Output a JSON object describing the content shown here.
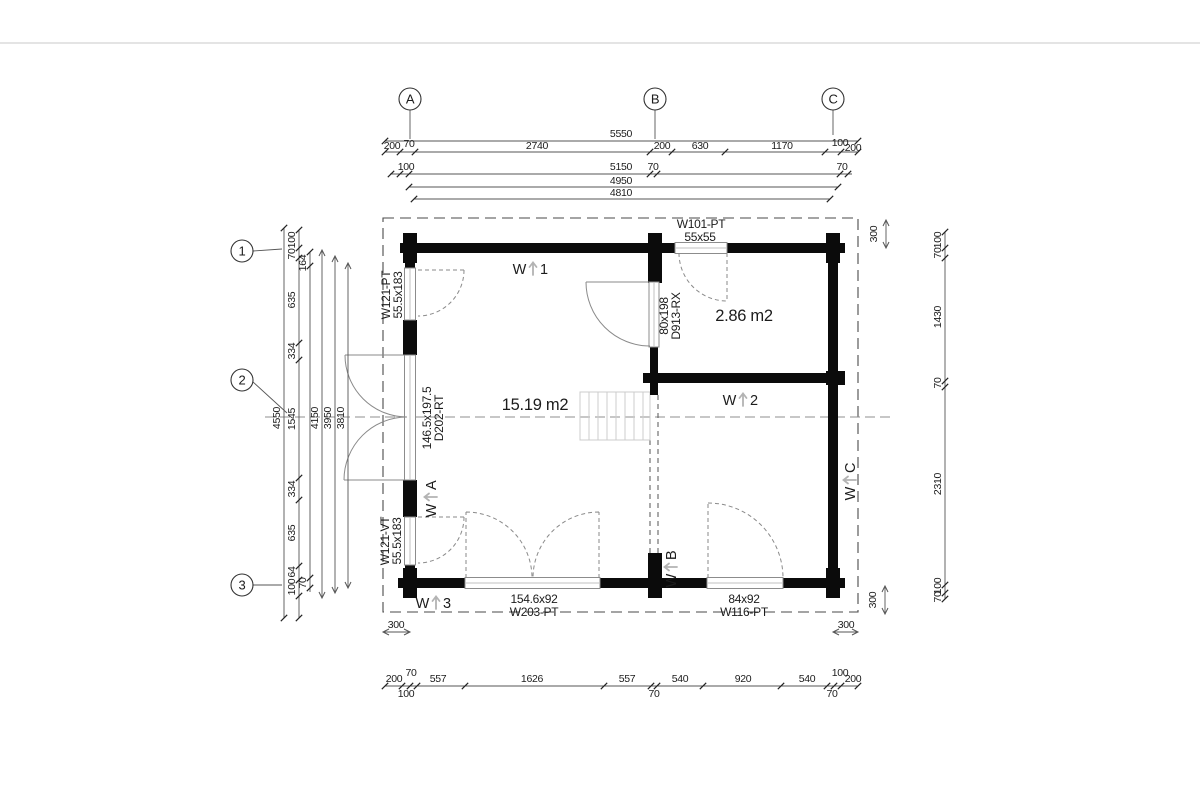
{
  "drawing_type": "floor-plan",
  "grid": {
    "cols": [
      {
        "label": "A",
        "cx": 410,
        "cy": 99,
        "lx1": 410,
        "ly1": 110,
        "lx2": 410,
        "ly2": 139
      },
      {
        "label": "B",
        "cx": 655,
        "cy": 99,
        "lx1": 655,
        "ly1": 110,
        "lx2": 655,
        "ly2": 139
      },
      {
        "label": "C",
        "cx": 833,
        "cy": 99,
        "lx1": 833,
        "ly1": 110,
        "lx2": 833,
        "ly2": 135
      }
    ],
    "rows": [
      {
        "label": "1",
        "cx": 242,
        "cy": 251,
        "lx1": 253,
        "ly1": 251,
        "lx2": 282,
        "ly2": 249
      },
      {
        "label": "2",
        "cx": 242,
        "cy": 380,
        "lx1": 253,
        "ly1": 382,
        "lx2": 287,
        "ly2": 413
      },
      {
        "label": "3",
        "cx": 242,
        "cy": 585,
        "lx1": 253,
        "ly1": 585,
        "lx2": 282,
        "ly2": 585
      }
    ]
  },
  "rooms": [
    {
      "name": "room-area-main",
      "text": "15.19 m2",
      "x": 535,
      "y": 410
    },
    {
      "name": "room-area-small",
      "text": "2.86 m2",
      "x": 744,
      "y": 321
    }
  ],
  "opening_labels": [
    {
      "name": "window-w101-label",
      "text": "W101-PT",
      "x": 701,
      "y": 228,
      "rot": 0
    },
    {
      "name": "window-w101-size",
      "text": "55x55",
      "x": 700,
      "y": 241,
      "rot": 0
    },
    {
      "name": "window-w121pt-label",
      "text": "W121-PT",
      "x": 390,
      "y": 295,
      "rot": -90
    },
    {
      "name": "window-w121pt-size",
      "text": "55.5x183",
      "x": 402,
      "y": 295,
      "rot": -90
    },
    {
      "name": "door-d202-size",
      "text": "146.5x197.5",
      "x": 431,
      "y": 418,
      "rot": -90
    },
    {
      "name": "door-d202-label",
      "text": "D202-RT",
      "x": 443,
      "y": 418,
      "rot": -90
    },
    {
      "name": "window-w121vt-label",
      "text": "W121-VT",
      "x": 389,
      "y": 541,
      "rot": -90
    },
    {
      "name": "window-w121vt-size",
      "text": "55.5x183",
      "x": 401,
      "y": 541,
      "rot": -90
    },
    {
      "name": "door-d913-size",
      "text": "80x198",
      "x": 668,
      "y": 316,
      "rot": -90
    },
    {
      "name": "door-d913-label",
      "text": "D913-RX",
      "x": 680,
      "y": 316,
      "rot": -90
    },
    {
      "name": "window-w203-size",
      "text": "154.6x92",
      "x": 534,
      "y": 603,
      "rot": 0
    },
    {
      "name": "window-w203-label",
      "text": "W203-PT",
      "x": 534,
      "y": 616,
      "rot": 0
    },
    {
      "name": "window-w116-size",
      "text": "84x92",
      "x": 744,
      "y": 603,
      "rot": 0
    },
    {
      "name": "window-w116-label",
      "text": "W116-PT",
      "x": 744,
      "y": 616,
      "rot": 0
    }
  ],
  "wall_marks": [
    {
      "name": "wall-mark-w1",
      "left": "W",
      "right": "1",
      "x": 531,
      "y": 269,
      "rot": 0
    },
    {
      "name": "wall-mark-w2",
      "left": "W",
      "right": "2",
      "x": 741,
      "y": 400,
      "rot": 0
    },
    {
      "name": "wall-mark-w3",
      "left": "W",
      "right": "3",
      "x": 434,
      "y": 603,
      "rot": 0
    },
    {
      "name": "wall-mark-wa",
      "left": "W",
      "right": "A",
      "x": 431,
      "y": 499,
      "rot": -90
    },
    {
      "name": "wall-mark-wb",
      "left": "W",
      "right": "B",
      "x": 671,
      "y": 569,
      "rot": -90
    },
    {
      "name": "wall-mark-wc",
      "left": "W",
      "right": "C",
      "x": 850,
      "y": 482,
      "rot": -90
    }
  ],
  "dims": {
    "h": [
      {
        "y": 141,
        "x1": 385,
        "x2": 858,
        "ticks": [
          385,
          858
        ],
        "arrows": false,
        "labels": [
          {
            "t": "5550",
            "x": 621,
            "y": 137
          }
        ]
      },
      {
        "y": 152,
        "x1": 385,
        "x2": 858,
        "ticks": [
          385,
          400,
          415,
          650,
          672,
          725,
          825,
          841,
          858
        ],
        "arrows": false,
        "labels": [
          {
            "t": "200",
            "x": 392,
            "y": 149
          },
          {
            "t": "70",
            "x": 409,
            "y": 147
          },
          {
            "t": "2740",
            "x": 537,
            "y": 149
          },
          {
            "t": "200",
            "x": 662,
            "y": 149
          },
          {
            "t": "630",
            "x": 700,
            "y": 149
          },
          {
            "t": "1170",
            "x": 782,
            "y": 149
          },
          {
            "t": "100",
            "x": 840,
            "y": 146
          },
          {
            "t": "200",
            "x": 853,
            "y": 151
          }
        ]
      },
      {
        "y": 174,
        "x1": 390,
        "x2": 852,
        "ticks": [
          391,
          400,
          409,
          650,
          657,
          840,
          848
        ],
        "arrows": false,
        "labels": [
          {
            "t": "100",
            "x": 406,
            "y": 170
          },
          {
            "t": "5150",
            "x": 621,
            "y": 170
          },
          {
            "t": "70",
            "x": 653,
            "y": 170
          },
          {
            "t": "70",
            "x": 842,
            "y": 170
          }
        ]
      },
      {
        "y": 187,
        "x1": 409,
        "x2": 838,
        "ticks": [
          409,
          838
        ],
        "arrows": false,
        "labels": [
          {
            "t": "4950",
            "x": 621,
            "y": 184
          }
        ]
      },
      {
        "y": 199,
        "x1": 414,
        "x2": 830,
        "ticks": [
          414,
          830
        ],
        "arrows": false,
        "labels": [
          {
            "t": "4810",
            "x": 621,
            "y": 196
          }
        ]
      },
      {
        "y": 686,
        "x1": 385,
        "x2": 858,
        "ticks": [
          385,
          402,
          410,
          417,
          465,
          604,
          651,
          657,
          703,
          781,
          827,
          834,
          841,
          858
        ],
        "arrows": false,
        "labels": [
          {
            "t": "200",
            "x": 394,
            "y": 682
          },
          {
            "t": "70",
            "x": 411,
            "y": 676
          },
          {
            "t": "100",
            "x": 406,
            "y": 697
          },
          {
            "t": "557",
            "x": 438,
            "y": 682
          },
          {
            "t": "1626",
            "x": 532,
            "y": 682
          },
          {
            "t": "557",
            "x": 627,
            "y": 682
          },
          {
            "t": "70",
            "x": 654,
            "y": 697
          },
          {
            "t": "540",
            "x": 680,
            "y": 682
          },
          {
            "t": "920",
            "x": 743,
            "y": 682
          },
          {
            "t": "540",
            "x": 807,
            "y": 682
          },
          {
            "t": "100",
            "x": 840,
            "y": 676
          },
          {
            "t": "70",
            "x": 832,
            "y": 697
          },
          {
            "t": "200",
            "x": 853,
            "y": 682
          }
        ]
      },
      {
        "y": 632,
        "x1": 383,
        "x2": 410,
        "ticks": [],
        "arrows": true,
        "labels": [
          {
            "t": "300",
            "x": 396,
            "y": 628
          }
        ]
      },
      {
        "y": 632,
        "x1": 833,
        "x2": 858,
        "ticks": [],
        "arrows": true,
        "labels": [
          {
            "t": "300",
            "x": 846,
            "y": 628
          }
        ]
      }
    ],
    "v": [
      {
        "x": 284,
        "y1": 228,
        "y2": 618,
        "ticks": [
          228,
          618
        ],
        "arrows": false,
        "labels": [
          {
            "t": "4550",
            "x": 280,
            "y": 418
          }
        ]
      },
      {
        "x": 299,
        "y1": 230,
        "y2": 618,
        "ticks": [
          230,
          248,
          258,
          343,
          360,
          478,
          500,
          566,
          580,
          596,
          618
        ],
        "arrows": false,
        "labels": [
          {
            "t": "100",
            "x": 295,
            "y": 240
          },
          {
            "t": "70",
            "x": 295,
            "y": 254
          },
          {
            "t": "635",
            "x": 295,
            "y": 300
          },
          {
            "t": "334",
            "x": 295,
            "y": 351
          },
          {
            "t": "1545",
            "x": 295,
            "y": 419
          },
          {
            "t": "334",
            "x": 295,
            "y": 489
          },
          {
            "t": "635",
            "x": 295,
            "y": 533
          },
          {
            "t": "64",
            "x": 295,
            "y": 572
          },
          {
            "t": "100",
            "x": 295,
            "y": 587
          }
        ]
      },
      {
        "x": 310,
        "y1": 252,
        "y2": 592,
        "ticks": [
          252,
          266,
          578,
          588
        ],
        "arrows": false,
        "labels": [
          {
            "t": "164",
            "x": 306,
            "y": 263
          },
          {
            "t": "70",
            "x": 306,
            "y": 583
          }
        ]
      },
      {
        "x": 322,
        "y1": 250,
        "y2": 598,
        "ticks": [],
        "arrows": true,
        "labels": [
          {
            "t": "4150",
            "x": 318,
            "y": 418
          }
        ]
      },
      {
        "x": 335,
        "y1": 256,
        "y2": 593,
        "ticks": [],
        "arrows": true,
        "labels": [
          {
            "t": "3950",
            "x": 331,
            "y": 418
          }
        ]
      },
      {
        "x": 348,
        "y1": 263,
        "y2": 588,
        "ticks": [],
        "arrows": true,
        "labels": [
          {
            "t": "3810",
            "x": 344,
            "y": 418
          }
        ]
      },
      {
        "x": 945,
        "y1": 232,
        "y2": 599,
        "ticks": [
          232,
          248,
          258,
          381,
          387,
          585,
          593,
          599
        ],
        "arrows": false,
        "labels": [
          {
            "t": "100",
            "x": 941,
            "y": 240
          },
          {
            "t": "70",
            "x": 941,
            "y": 253
          },
          {
            "t": "1430",
            "x": 941,
            "y": 317
          },
          {
            "t": "70",
            "x": 941,
            "y": 383
          },
          {
            "t": "2310",
            "x": 941,
            "y": 484
          },
          {
            "t": "100",
            "x": 941,
            "y": 586
          },
          {
            "t": "70",
            "x": 941,
            "y": 597
          }
        ]
      },
      {
        "x": 886,
        "y1": 220,
        "y2": 248,
        "ticks": [],
        "arrows": true,
        "labels": [
          {
            "t": "300",
            "x": 877,
            "y": 234
          }
        ]
      },
      {
        "x": 885,
        "y1": 586,
        "y2": 614,
        "ticks": [],
        "arrows": true,
        "labels": [
          {
            "t": "300",
            "x": 876,
            "y": 600
          }
        ]
      }
    ]
  },
  "colors": {
    "wall": "#0b0b0b",
    "thin": "#555555",
    "swing": "#8a8a8a",
    "stair": "#cccccc",
    "arrow_mark": "#b3b3b3"
  }
}
